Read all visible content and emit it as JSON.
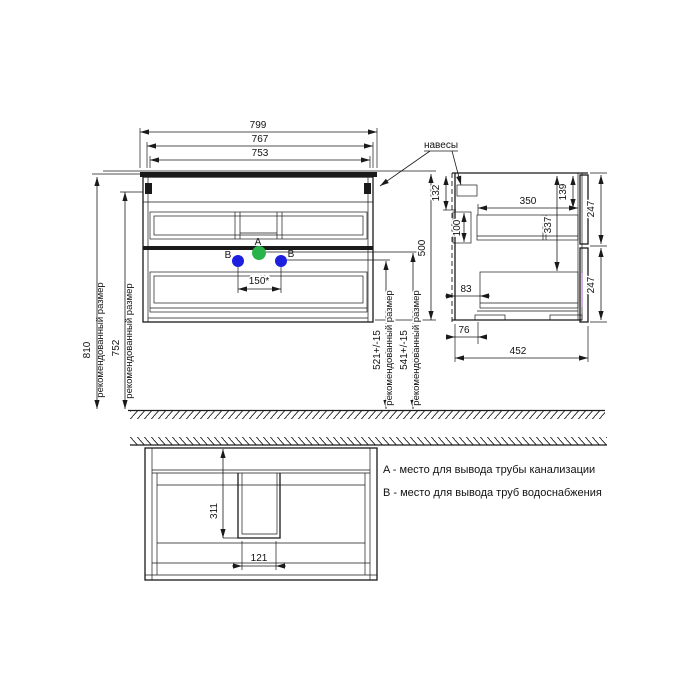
{
  "fv": {
    "d799": "799",
    "d767": "767",
    "d753": "753",
    "d150": "150*",
    "a": "A",
    "b": "B",
    "d810": "810",
    "d752": "752",
    "rec": "рекомендованный размер",
    "d521": "521+/-15",
    "d541": "541+/-15",
    "d500": "500"
  },
  "sv": {
    "d132": "132",
    "d100": "100",
    "d350": "350",
    "d139": "139",
    "d337": "337",
    "d247": "247",
    "d83": "83",
    "d76": "76",
    "d452": "452"
  },
  "bv": {
    "d311": "311",
    "d121": "121"
  },
  "ann": {
    "hangers": "навесы"
  },
  "legend": {
    "a": "A - место для вывода трубы канализации",
    "b": "B - место для вывода труб водоснабжения"
  },
  "colors": {
    "drain": "#2ab34a",
    "water": "#1c20de",
    "ink": "#1a1a1a"
  }
}
